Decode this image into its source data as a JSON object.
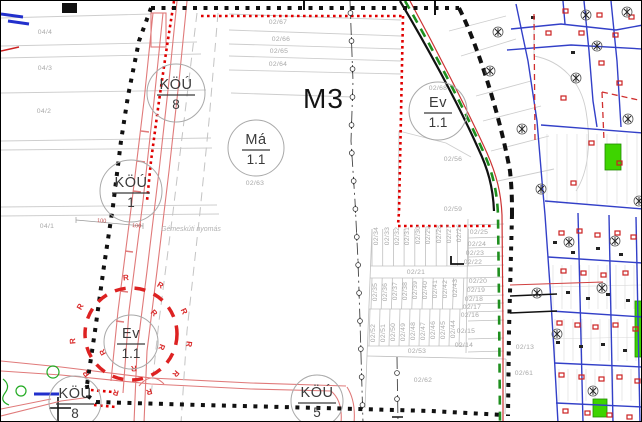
{
  "map": {
    "title_label": "M3",
    "note": "Gémeskúti nyomás",
    "dimension_labels": [
      "100",
      "100"
    ],
    "radius_letter": "R",
    "zone_circles": [
      {
        "id": "kou-8-top",
        "numerator": "KÖÚ",
        "denominator": "8",
        "cx": 175,
        "cy": 92,
        "r": 29
      },
      {
        "id": "kou-1",
        "numerator": "KÖÚ",
        "denominator": "1",
        "cx": 130,
        "cy": 190,
        "r": 31
      },
      {
        "id": "ma-1-1",
        "numerator": "Má",
        "denominator": "1.1",
        "cx": 255,
        "cy": 147,
        "r": 28
      },
      {
        "id": "ev-1-1-top",
        "numerator": "Ev",
        "denominator": "1.1",
        "cx": 437,
        "cy": 110,
        "r": 29
      },
      {
        "id": "ev-1-1-bottom",
        "numerator": "Ev",
        "denominator": "1.1",
        "cx": 130,
        "cy": 341,
        "r": 27
      },
      {
        "id": "kou-8-bottom",
        "numerator": "KÖÚ",
        "denominator": "8",
        "cx": 74,
        "cy": 401,
        "r": 26
      },
      {
        "id": "kou-5-bottom",
        "numerator": "KÖÚ",
        "denominator": "5",
        "cx": 316,
        "cy": 400,
        "r": 26
      }
    ],
    "parcel_labels": [
      {
        "t": "04/4",
        "x": 44,
        "y": 33,
        "r": 0
      },
      {
        "t": "04/3",
        "x": 44,
        "y": 69,
        "r": 0
      },
      {
        "t": "04/2",
        "x": 43,
        "y": 112,
        "r": 0
      },
      {
        "t": "04/1",
        "x": 46,
        "y": 227,
        "r": 0
      },
      {
        "t": "02/67",
        "x": 277,
        "y": 23,
        "r": 0
      },
      {
        "t": "02/66",
        "x": 280,
        "y": 40,
        "r": 0
      },
      {
        "t": "02/65",
        "x": 278,
        "y": 52,
        "r": 0
      },
      {
        "t": "02/64",
        "x": 277,
        "y": 65,
        "r": 0
      },
      {
        "t": "02/63",
        "x": 254,
        "y": 184,
        "r": 0
      },
      {
        "t": "02/68",
        "x": 437,
        "y": 89,
        "r": 0
      },
      {
        "t": "02/56",
        "x": 452,
        "y": 160,
        "r": 0
      },
      {
        "t": "02/59",
        "x": 452,
        "y": 210,
        "r": 0
      },
      {
        "t": "02/21",
        "x": 415,
        "y": 273,
        "r": 0
      },
      {
        "t": "02/53",
        "x": 416,
        "y": 352,
        "r": 0
      },
      {
        "t": "02/62",
        "x": 422,
        "y": 381,
        "r": 0
      },
      {
        "t": "02/61",
        "x": 523,
        "y": 374,
        "r": 0
      },
      {
        "t": "02/13",
        "x": 524,
        "y": 348,
        "r": 0
      },
      {
        "t": "02/25",
        "x": 478,
        "y": 233,
        "r": 0
      },
      {
        "t": "02/24",
        "x": 476,
        "y": 245,
        "r": 0
      },
      {
        "t": "02/23",
        "x": 474,
        "y": 254,
        "r": 0
      },
      {
        "t": "02/22",
        "x": 472,
        "y": 263,
        "r": 0
      },
      {
        "t": "02/20",
        "x": 477,
        "y": 282,
        "r": 0
      },
      {
        "t": "02/19",
        "x": 475,
        "y": 291,
        "r": 0
      },
      {
        "t": "02/18",
        "x": 473,
        "y": 300,
        "r": 0
      },
      {
        "t": "02/17",
        "x": 471,
        "y": 308,
        "r": 0
      },
      {
        "t": "02/16",
        "x": 469,
        "y": 316,
        "r": 0
      },
      {
        "t": "02/15",
        "x": 465,
        "y": 332,
        "r": 0
      },
      {
        "t": "02/14",
        "x": 463,
        "y": 346,
        "r": 0
      },
      {
        "t": "02/34",
        "x": 377,
        "y": 235,
        "r": -90
      },
      {
        "t": "02/33",
        "x": 388,
        "y": 235,
        "r": -90
      },
      {
        "t": "02/32",
        "x": 398,
        "y": 235,
        "r": -90
      },
      {
        "t": "02/31",
        "x": 408,
        "y": 235,
        "r": -90
      },
      {
        "t": "02/30",
        "x": 419,
        "y": 234,
        "r": -90
      },
      {
        "t": "02/29",
        "x": 429,
        "y": 234,
        "r": -90
      },
      {
        "t": "02/28",
        "x": 440,
        "y": 233,
        "r": -90
      },
      {
        "t": "02/27",
        "x": 450,
        "y": 233,
        "r": -90
      },
      {
        "t": "02/26",
        "x": 460,
        "y": 232,
        "r": -90
      },
      {
        "t": "02/35",
        "x": 376,
        "y": 291,
        "r": -90
      },
      {
        "t": "02/36",
        "x": 386,
        "y": 291,
        "r": -90
      },
      {
        "t": "02/37",
        "x": 396,
        "y": 290,
        "r": -90
      },
      {
        "t": "02/38",
        "x": 406,
        "y": 290,
        "r": -90
      },
      {
        "t": "02/39",
        "x": 416,
        "y": 289,
        "r": -90
      },
      {
        "t": "02/40",
        "x": 426,
        "y": 289,
        "r": -90
      },
      {
        "t": "02/41",
        "x": 436,
        "y": 288,
        "r": -90
      },
      {
        "t": "02/42",
        "x": 446,
        "y": 288,
        "r": -90
      },
      {
        "t": "02/43",
        "x": 456,
        "y": 287,
        "r": -90
      },
      {
        "t": "02/52",
        "x": 374,
        "y": 332,
        "r": -90
      },
      {
        "t": "02/51",
        "x": 384,
        "y": 332,
        "r": -90
      },
      {
        "t": "02/50",
        "x": 394,
        "y": 331,
        "r": -90
      },
      {
        "t": "02/49",
        "x": 404,
        "y": 331,
        "r": -90
      },
      {
        "t": "02/48",
        "x": 414,
        "y": 330,
        "r": -90
      },
      {
        "t": "02/47",
        "x": 424,
        "y": 330,
        "r": -90
      },
      {
        "t": "02/46",
        "x": 434,
        "y": 329,
        "r": -90
      },
      {
        "t": "02/45",
        "x": 444,
        "y": 329,
        "r": -90
      },
      {
        "t": "02/44",
        "x": 454,
        "y": 328,
        "r": -90
      }
    ],
    "colors": {
      "boundary_black": "#111111",
      "regulation_red": "#e00000",
      "road_red": "#e07a7a",
      "green_line": "#1f8f1f",
      "green_fill": "#3ed400",
      "street_blue": "#3340c8",
      "parcel_gray": "#a8a8a8"
    }
  }
}
